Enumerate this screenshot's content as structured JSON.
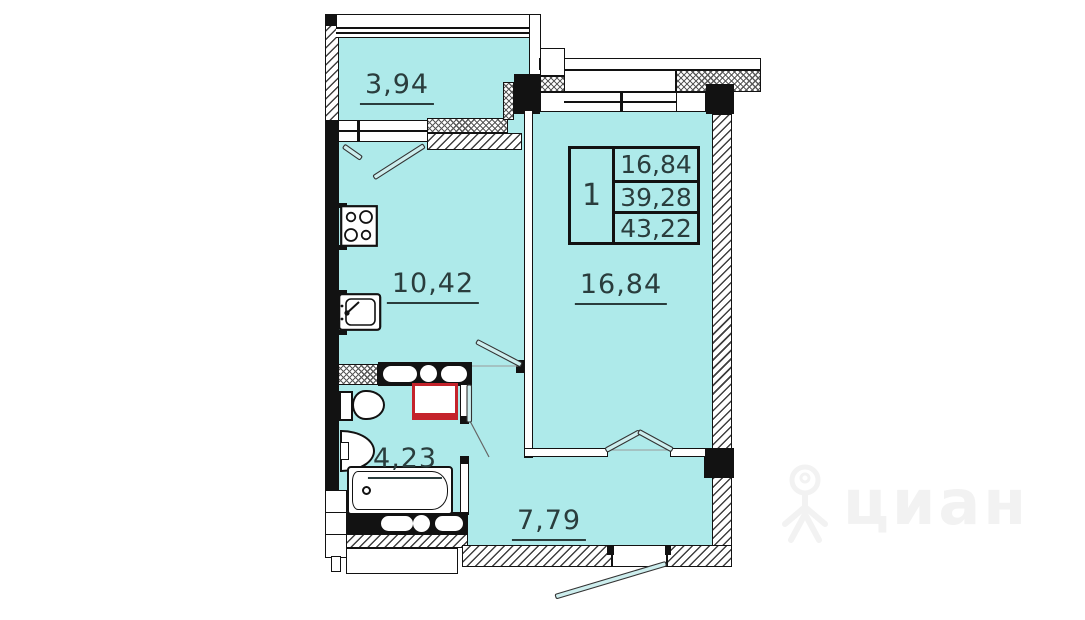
{
  "plan": {
    "labels": {
      "balcony": "3,94",
      "kitchen": "10,42",
      "living_room": "16,84",
      "bathroom": "4,23",
      "hallway": "7,79"
    },
    "info_table": {
      "rooms_count": "1",
      "rows": [
        "16,84",
        "39,28",
        "43,22"
      ]
    },
    "colors": {
      "room_fill": "#aeeaea",
      "wall": "#121212",
      "label_text": "#2a3d3d",
      "appliance_accent": "#c4232b",
      "watermark": "#f2f2f2"
    }
  },
  "watermark": {
    "brand": "циан"
  }
}
